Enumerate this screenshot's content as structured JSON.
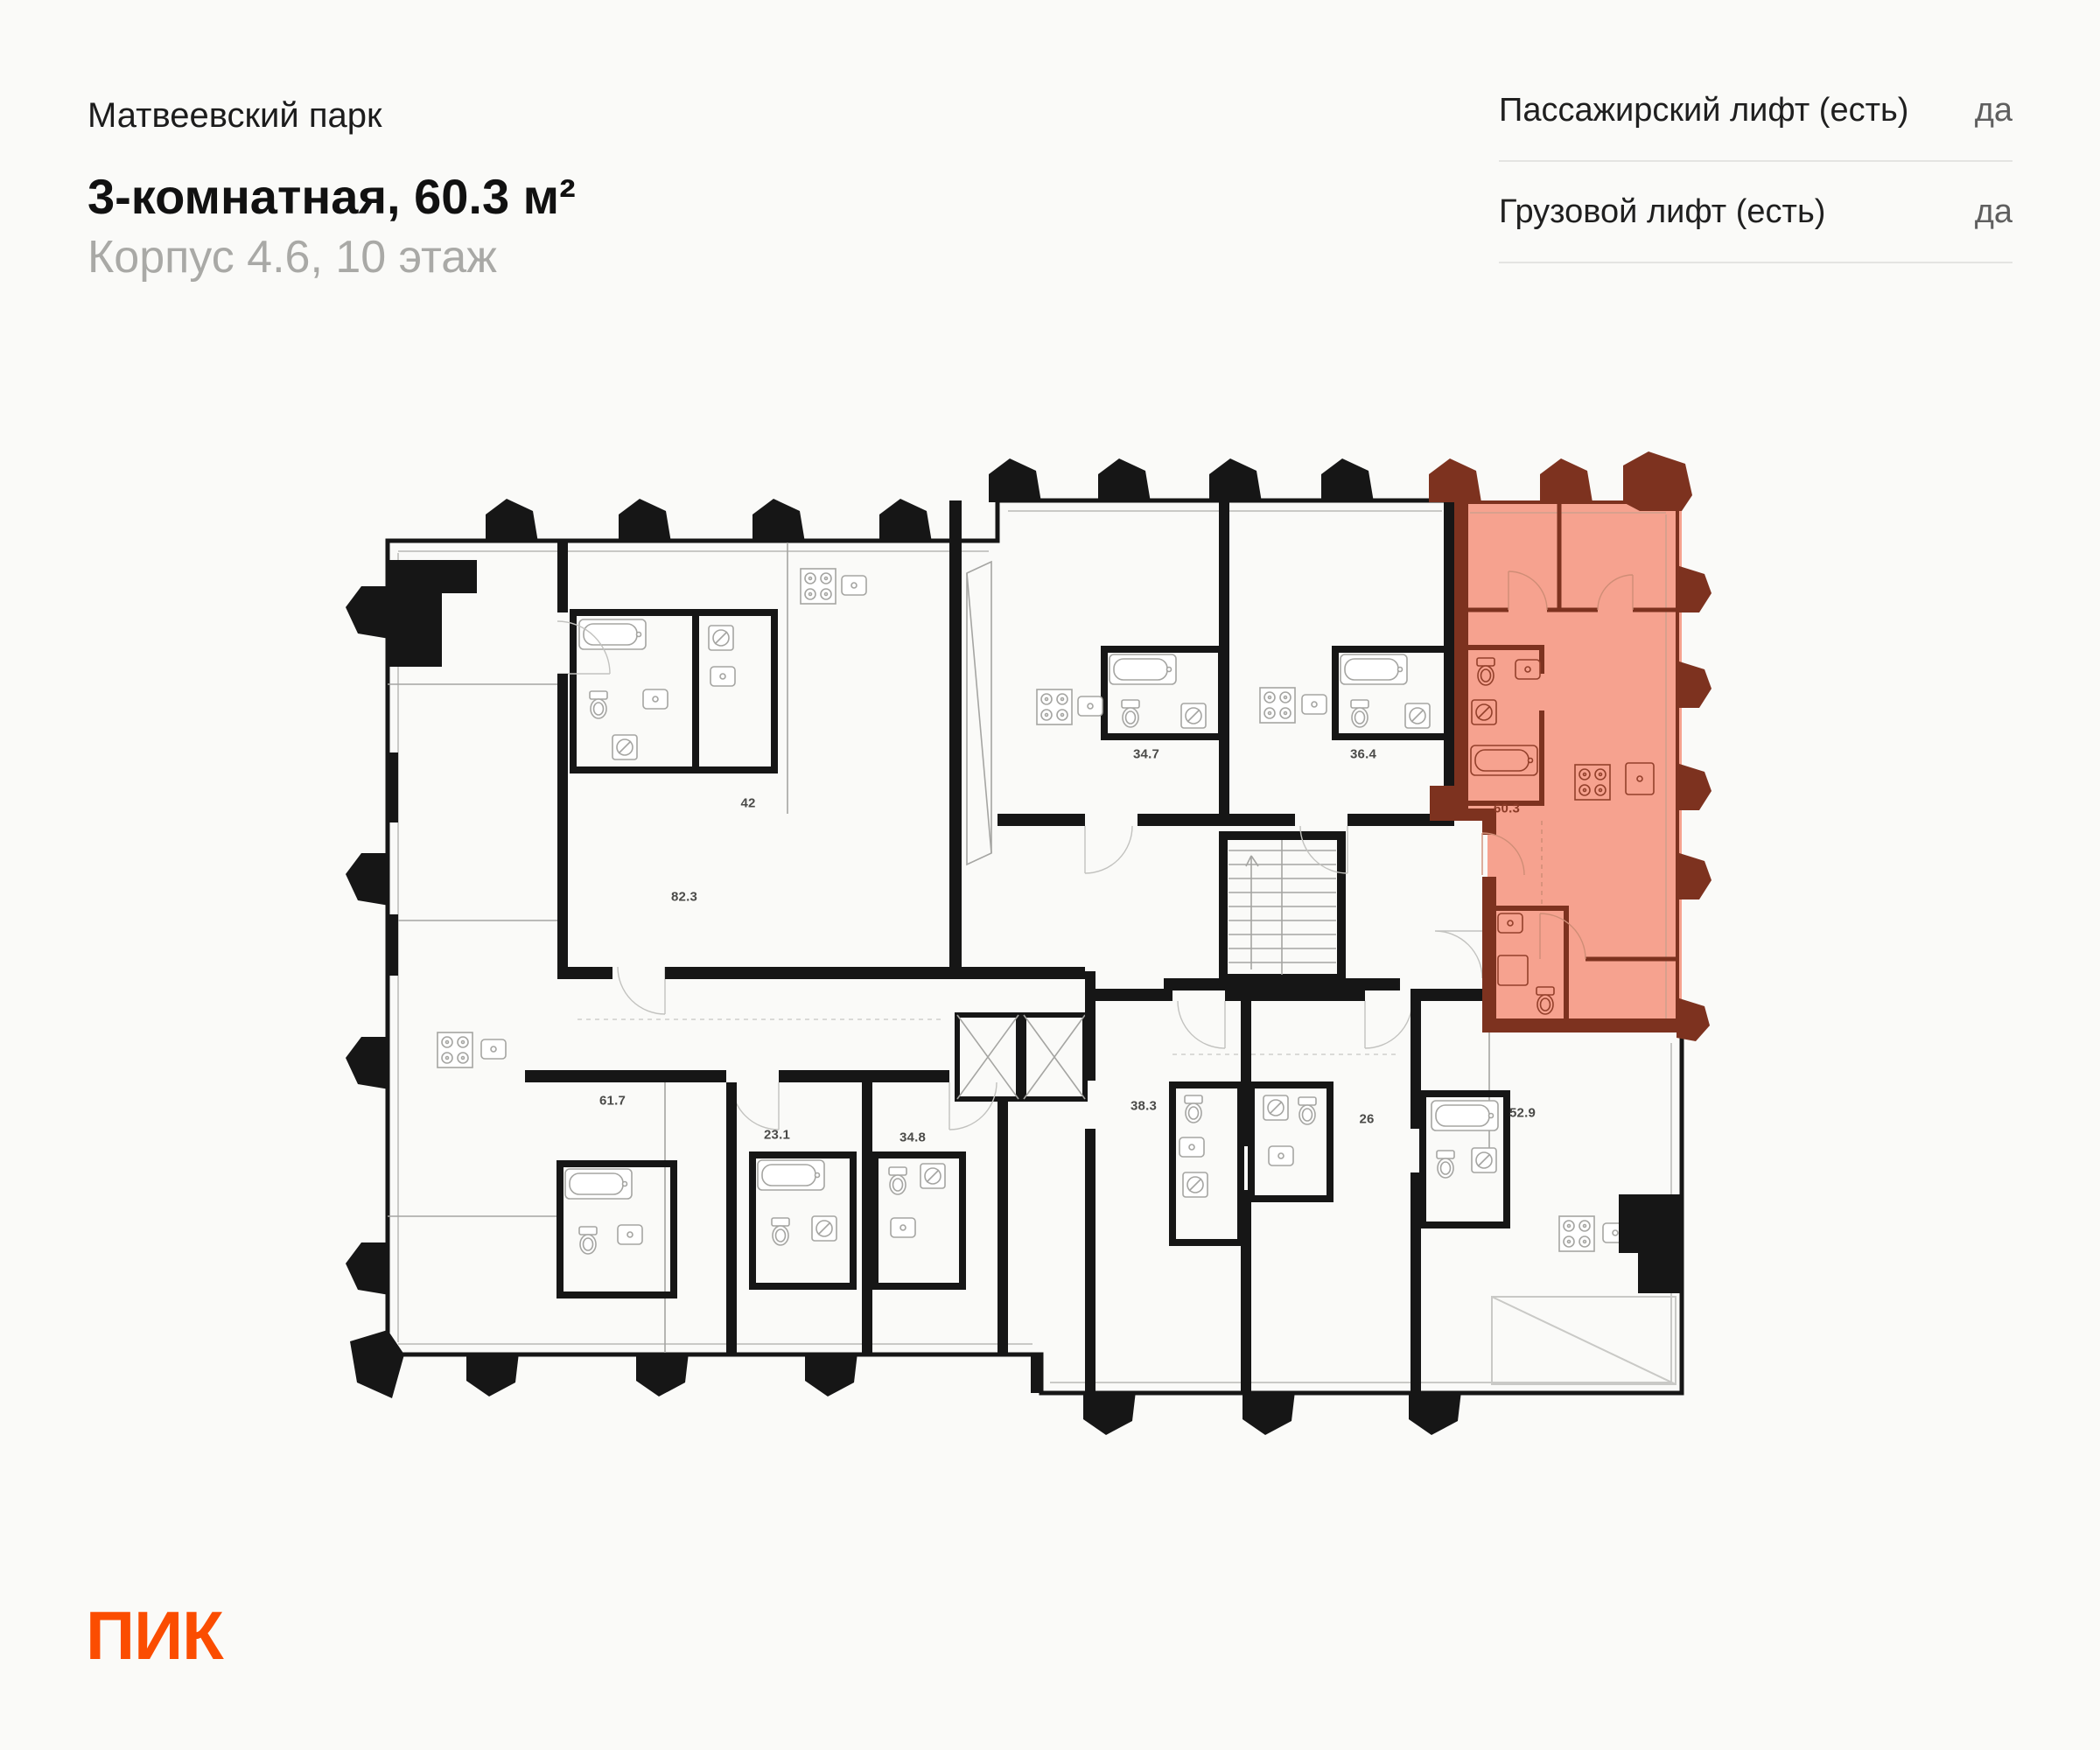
{
  "header": {
    "project": "Матвеевский парк",
    "title": "3-комнатная, 60.3 м²",
    "subtitle": "Корпус 4.6, 10 этаж"
  },
  "lift_info": {
    "rows": [
      {
        "label": "Пассажирский лифт (есть)",
        "value": "да"
      },
      {
        "label": "Грузовой лифт (есть)",
        "value": "да"
      }
    ]
  },
  "plan": {
    "highlighted_area": "60.3",
    "areas": [
      "42",
      "82.3",
      "34.7",
      "36.4",
      "61.7",
      "23.1",
      "34.8",
      "38.3",
      "26",
      "52.9"
    ]
  },
  "logo": {
    "text": "ПИК"
  },
  "colors": {
    "highlight_fill": "#f6a28f",
    "highlight_wall": "#7d321f",
    "walls": "#161616",
    "logo_orange": "#fb4d01"
  }
}
